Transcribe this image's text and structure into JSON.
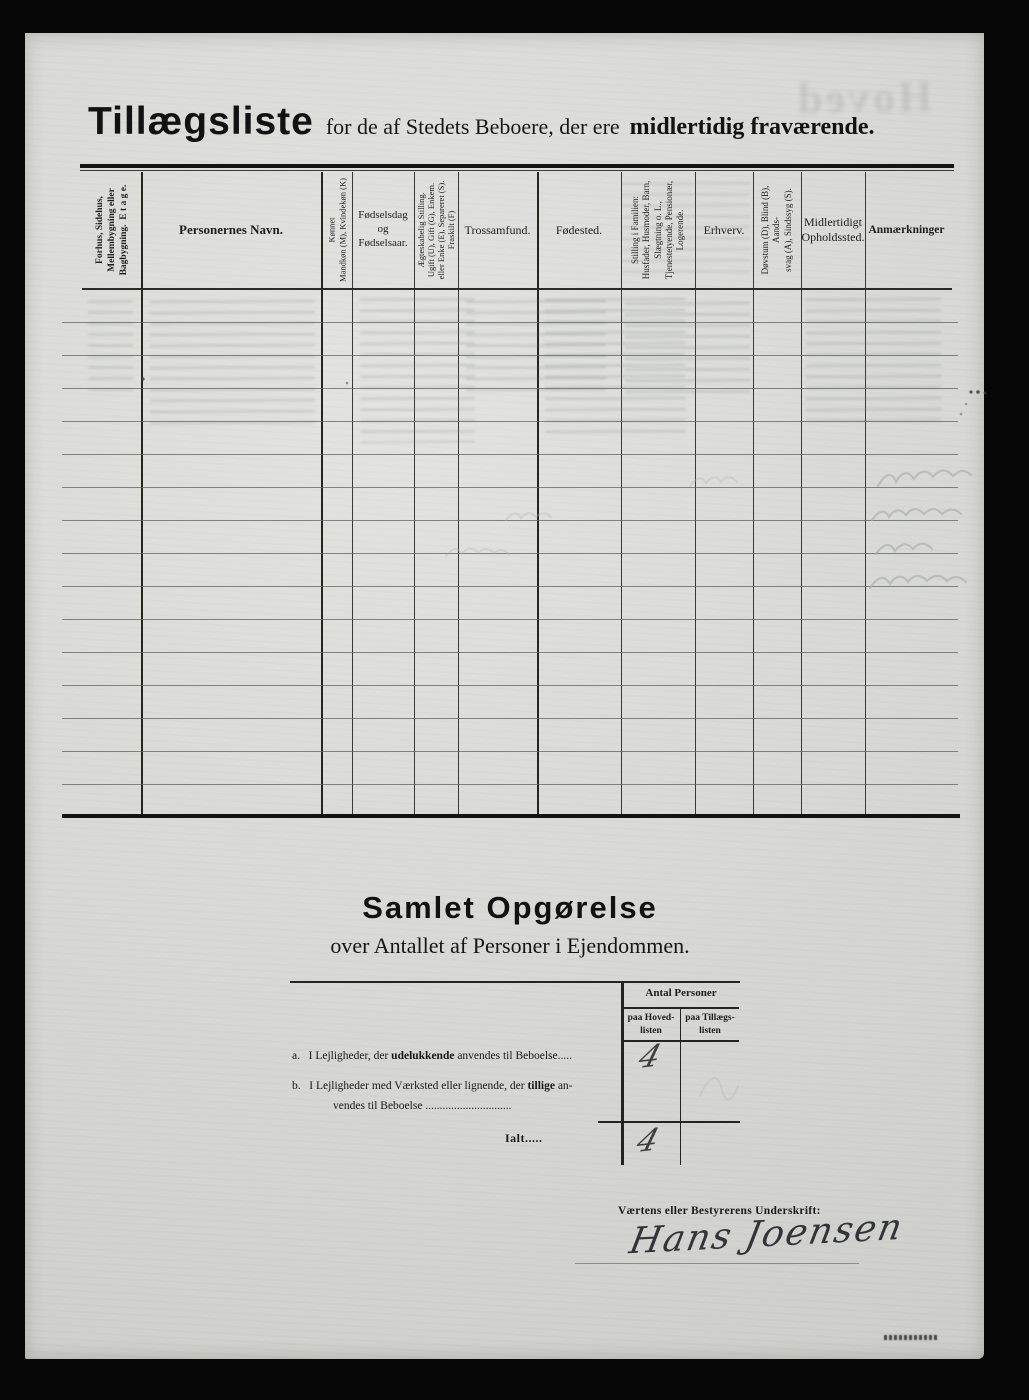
{
  "header": {
    "title_main": "Tillægsliste",
    "title_mid": "for de af Stedets Beboere, der ere",
    "title_bold": "midlertidig fraværende.",
    "ghost": "Hoved"
  },
  "table": {
    "body_rows": 16,
    "columns": [
      {
        "label": "Forhus, Sidehus,\nMellembygning eller\nBagbygning.  E t a g e.",
        "rotated": true
      },
      {
        "label": "Personernes Navn.",
        "rotated": false
      },
      {
        "label": "Kønnet\nMandkøn (M), Kvindekøn (K)",
        "rotated": true
      },
      {
        "label": "Fødselsdag\nog\nFødselsaar.",
        "rotated": false
      },
      {
        "label": "Ægteskabelig Stilling.\nUgift (U), Gift (G), Enkem.\neller Enke (E), Separeret (S).\nFraskilt (F)",
        "rotated": true
      },
      {
        "label": "Trossamfund.",
        "rotated": false
      },
      {
        "label": "Fødested.",
        "rotated": false
      },
      {
        "label": "Stilling i Familien:\nHusfader, Husmoder, Barn,\nSlægtning o. L.,\nTjenestetyende, Pensionær,\nLogerende.",
        "rotated": true
      },
      {
        "label": "Erhverv.",
        "rotated": false
      },
      {
        "label": "Døvstum (D), Blind (B), Aands-\nsvag (A), Sindssyg (S).",
        "rotated": true
      },
      {
        "label": "Midlertidigt\nOpholdssted.",
        "rotated": false
      },
      {
        "label": "Anmærkninger",
        "rotated": false
      }
    ]
  },
  "summary": {
    "title": "Samlet Opgørelse",
    "subtitle": "over Antallet af Personer i Ejendommen.",
    "antal_header": "Antal Personer",
    "col_hoved": "paa Hoved-\nlisten",
    "col_tillaeg": "paa Tillægs-\nlisten",
    "row_a_label": "a.",
    "row_a_pre": "I Lejligheder, der ",
    "row_a_bold": "udelukkende",
    "row_a_post": " anvendes til Beboelse.....",
    "row_b_label": "b.",
    "row_b_pre": "I Lejligheder med Værksted eller lignende, der ",
    "row_b_bold": "tillige",
    "row_b_post": " an-",
    "row_b_line2": "vendes til Beboelse ..............................",
    "total_label": "Ialt.....",
    "value_a": "4",
    "value_total": "4"
  },
  "signature": {
    "label": "Værtens eller Bestyrerens Underskrift:",
    "name": "Hans Joensen"
  }
}
